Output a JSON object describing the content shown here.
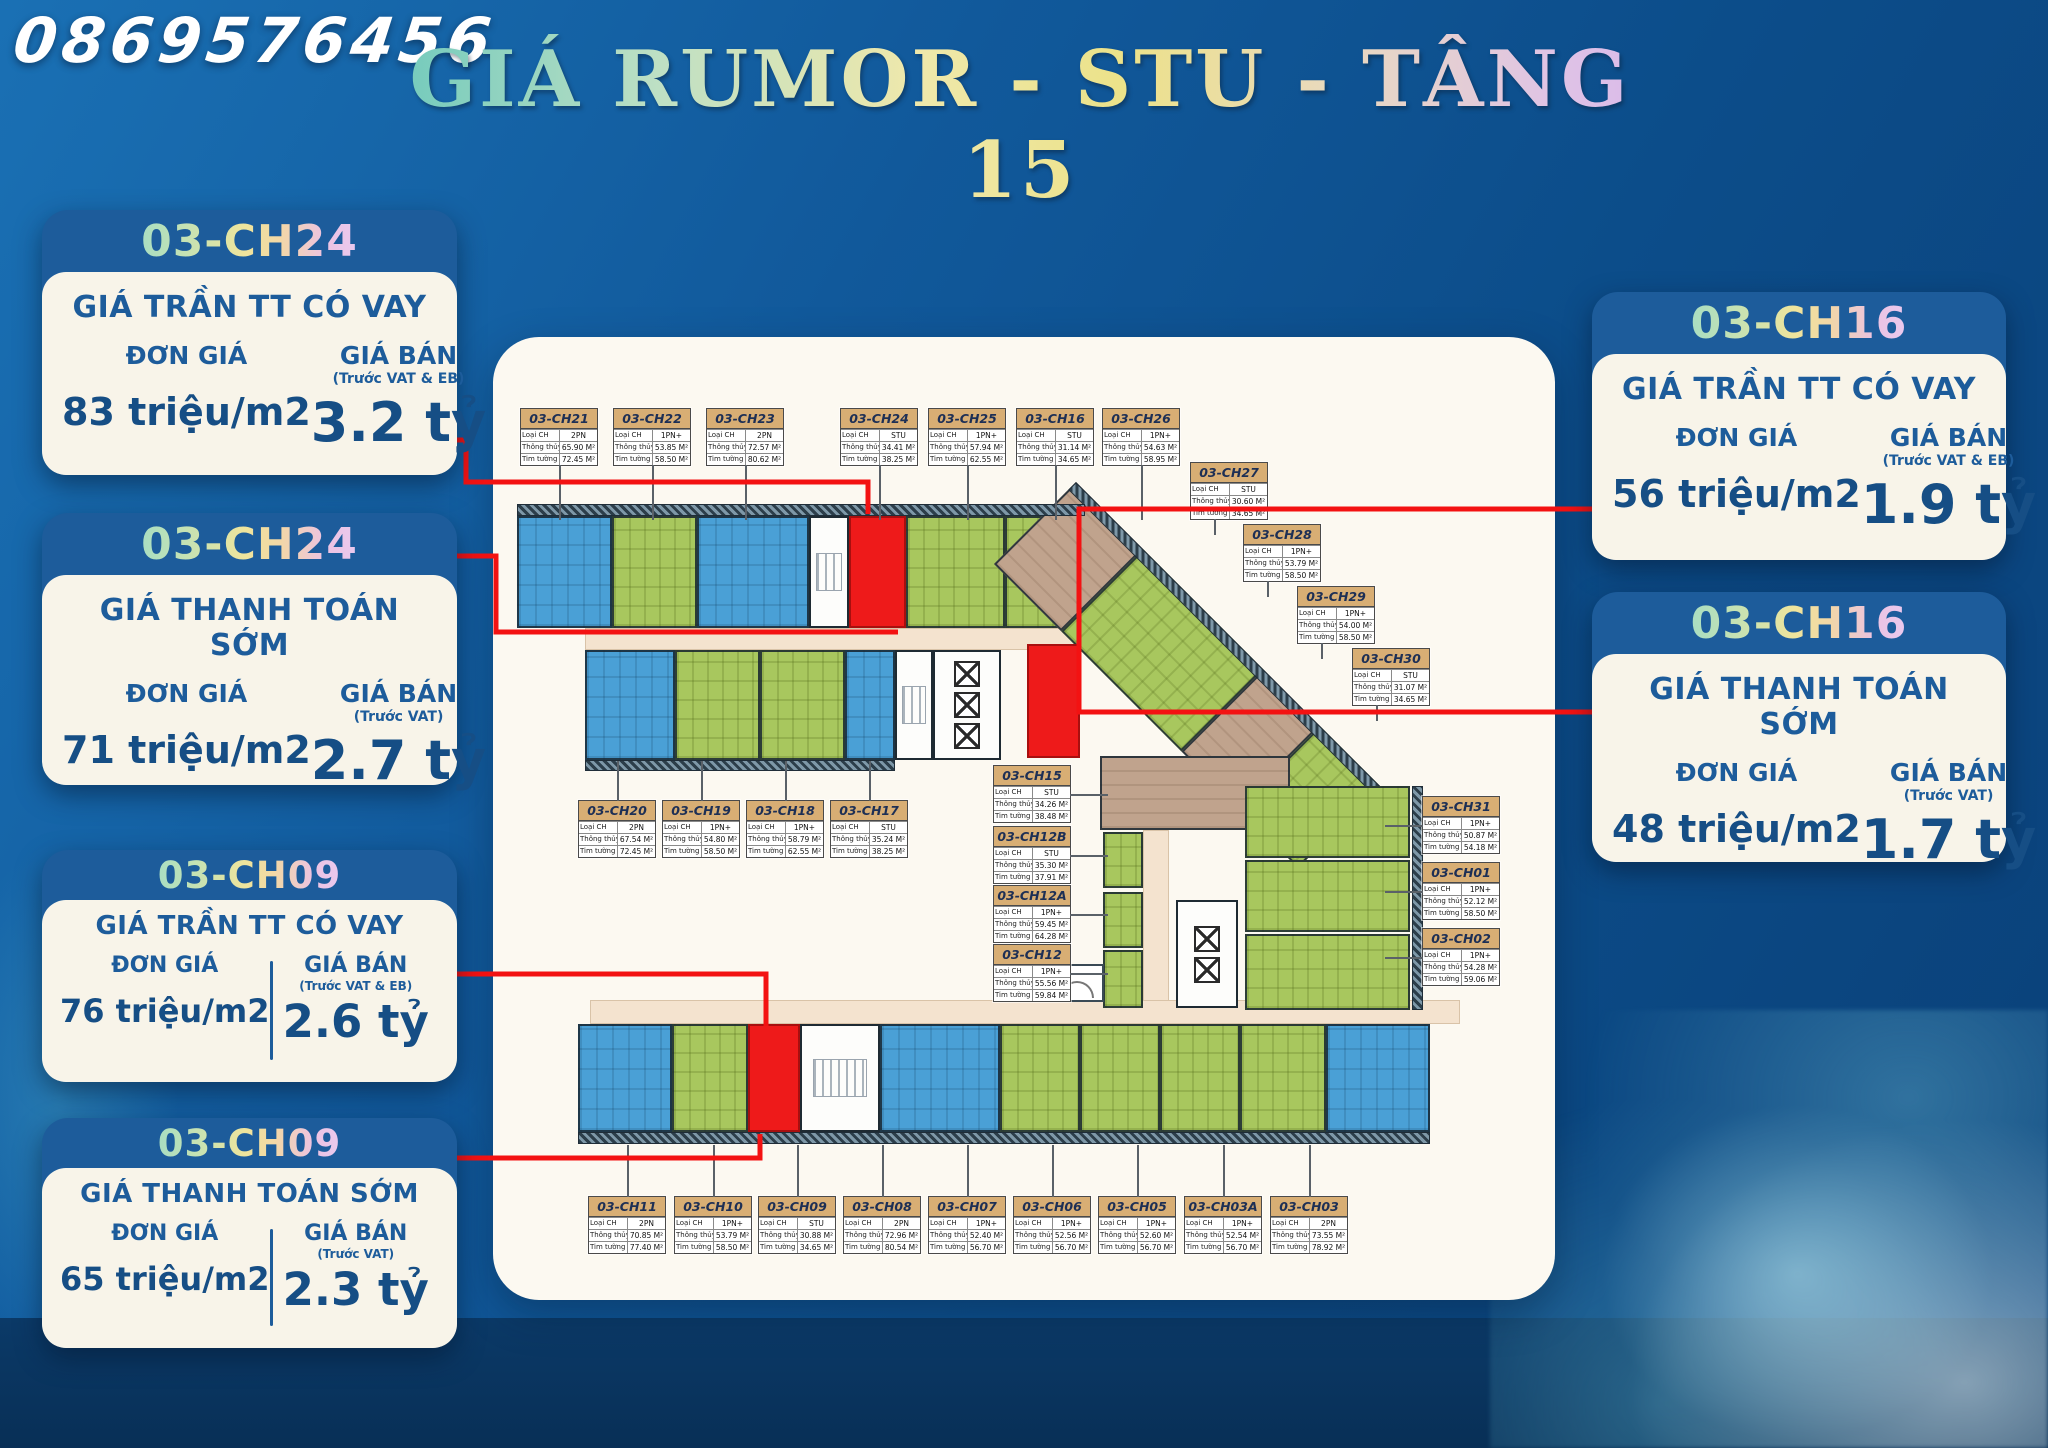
{
  "header": {
    "phone": "0869576456",
    "title": "GIÁ RUMOR - STU - TẦNG 15"
  },
  "colors": {
    "background_blue": "#0f5694",
    "bottom_band_navy": "#0b3a68",
    "card_header_blue": "#1d5c9b",
    "card_body_cream": "#f8f4e9",
    "accent_red": "#f31212",
    "highlight_unit_red": "#ee1a1a",
    "unit_blue": "#4aa0d6",
    "unit_green": "#a8c75e",
    "unit_brown": "#c0a38d",
    "corridor_beige": "#f4e3cf",
    "label_header_tan": "#d8ae74"
  },
  "cards": [
    {
      "code": "03-CH24",
      "title": "GIÁ TRẦN TT CÓ VAY",
      "don_gia_label": "ĐƠN GIÁ",
      "don_gia": "83 triệu/m2",
      "gia_ban_label": "GIÁ BÁN",
      "gia_ban_note": "(Trước VAT & EB)",
      "gia_ban": "3.2 tỷ"
    },
    {
      "code": "03-CH24",
      "title": "GIÁ THANH TOÁN SỚM",
      "don_gia_label": "ĐƠN GIÁ",
      "don_gia": "71 triệu/m2",
      "gia_ban_label": "GIÁ BÁN",
      "gia_ban_note": "(Trước VAT)",
      "gia_ban": "2.7 tỷ"
    },
    {
      "code": "03-CH09",
      "title": "GIÁ TRẦN TT CÓ VAY",
      "don_gia_label": "ĐƠN GIÁ",
      "don_gia": "76 triệu/m2",
      "gia_ban_label": "GIÁ BÁN",
      "gia_ban_note": "(Trước VAT & EB)",
      "gia_ban": "2.6 tỷ"
    },
    {
      "code": "03-CH09",
      "title": "GIÁ THANH TOÁN SỚM",
      "don_gia_label": "ĐƠN GIÁ",
      "don_gia": "65 triệu/m2",
      "gia_ban_label": "GIÁ BÁN",
      "gia_ban_note": "(Trước VAT)",
      "gia_ban": "2.3 tỷ"
    },
    {
      "code": "03-CH16",
      "title": "GIÁ TRẦN TT CÓ VAY",
      "don_gia_label": "ĐƠN GIÁ",
      "don_gia": "56 triệu/m2",
      "gia_ban_label": "GIÁ BÁN",
      "gia_ban_note": "(Trước VAT & EB)",
      "gia_ban": "1.9 tỷ"
    },
    {
      "code": "03-CH16",
      "title": "GIÁ THANH TOÁN SỚM",
      "don_gia_label": "ĐƠN GIÁ",
      "don_gia": "48 triệu/m2",
      "gia_ban_label": "GIÁ BÁN",
      "gia_ban_note": "(Trước VAT)",
      "gia_ban": "1.7 tỷ"
    }
  ],
  "plan": {
    "fields": {
      "type": "Loại CH",
      "net": "Thông thủy",
      "gross": "Tim tường"
    },
    "labels": [
      {
        "code": "03-CH21",
        "type": "2PN",
        "net": "65.90 M²",
        "gross": "72.45 M²",
        "x": 520,
        "y": 408,
        "stub": "down"
      },
      {
        "code": "03-CH22",
        "type": "1PN+",
        "net": "53.85 M²",
        "gross": "58.50 M²",
        "x": 613,
        "y": 408,
        "stub": "down"
      },
      {
        "code": "03-CH23",
        "type": "2PN",
        "net": "72.57 M²",
        "gross": "80.62 M²",
        "x": 706,
        "y": 408,
        "stub": "down"
      },
      {
        "code": "03-CH24",
        "type": "STU",
        "net": "34.41 M²",
        "gross": "38.25 M²",
        "x": 840,
        "y": 408,
        "stub": "down"
      },
      {
        "code": "03-CH25",
        "type": "1PN+",
        "net": "57.94 M²",
        "gross": "62.55 M²",
        "x": 928,
        "y": 408,
        "stub": "down"
      },
      {
        "code": "03-CH16",
        "type": "STU",
        "net": "31.14 M²",
        "gross": "34.65 M²",
        "x": 1016,
        "y": 408,
        "stub": "down"
      },
      {
        "code": "03-CH26",
        "type": "1PN+",
        "net": "54.63 M²",
        "gross": "58.95 M²",
        "x": 1102,
        "y": 408,
        "stub": "down"
      },
      {
        "code": "03-CH27",
        "type": "STU",
        "net": "30.60 M²",
        "gross": "34.65 M²",
        "x": 1190,
        "y": 462,
        "stub": "down-sm"
      },
      {
        "code": "03-CH28",
        "type": "1PN+",
        "net": "53.79 M²",
        "gross": "58.50 M²",
        "x": 1243,
        "y": 524,
        "stub": "down-sm"
      },
      {
        "code": "03-CH29",
        "type": "1PN+",
        "net": "54.00 M²",
        "gross": "58.50 M²",
        "x": 1297,
        "y": 586,
        "stub": "down-sm"
      },
      {
        "code": "03-CH30",
        "type": "STU",
        "net": "31.07 M²",
        "gross": "34.65 M²",
        "x": 1352,
        "y": 648,
        "stub": "down-sm"
      },
      {
        "code": "03-CH20",
        "type": "2PN",
        "net": "67.54 M²",
        "gross": "72.45 M²",
        "x": 578,
        "y": 800,
        "stub": "up"
      },
      {
        "code": "03-CH19",
        "type": "1PN+",
        "net": "54.80 M²",
        "gross": "58.50 M²",
        "x": 662,
        "y": 800,
        "stub": "up"
      },
      {
        "code": "03-CH18",
        "type": "1PN+",
        "net": "58.79 M²",
        "gross": "62.55 M²",
        "x": 746,
        "y": 800,
        "stub": "up"
      },
      {
        "code": "03-CH17",
        "type": "STU",
        "net": "35.24 M²",
        "gross": "38.25 M²",
        "x": 830,
        "y": 800,
        "stub": "up"
      },
      {
        "code": "03-CH15",
        "type": "STU",
        "net": "34.26 M²",
        "gross": "38.48 M²",
        "x": 993,
        "y": 765,
        "stub": "right"
      },
      {
        "code": "03-CH12B",
        "type": "STU",
        "net": "35.30 M²",
        "gross": "37.91 M²",
        "x": 993,
        "y": 826,
        "stub": "right"
      },
      {
        "code": "03-CH12A",
        "type": "1PN+",
        "net": "59.45 M²",
        "gross": "64.28 M²",
        "x": 993,
        "y": 885,
        "stub": "right"
      },
      {
        "code": "03-CH12",
        "type": "1PN+",
        "net": "55.56 M²",
        "gross": "59.84 M²",
        "x": 993,
        "y": 944,
        "stub": "right"
      },
      {
        "code": "03-CH31",
        "type": "1PN+",
        "net": "50.87 M²",
        "gross": "54.18 M²",
        "x": 1422,
        "y": 796,
        "stub": "left"
      },
      {
        "code": "03-CH01",
        "type": "1PN+",
        "net": "52.12 M²",
        "gross": "58.50 M²",
        "x": 1422,
        "y": 862,
        "stub": "left"
      },
      {
        "code": "03-CH02",
        "type": "1PN+",
        "net": "54.28 M²",
        "gross": "59.06 M²",
        "x": 1422,
        "y": 928,
        "stub": "left"
      },
      {
        "code": "03-CH11",
        "type": "2PN",
        "net": "70.85 M²",
        "gross": "77.40 M²",
        "x": 588,
        "y": 1196,
        "stub": "up-lg"
      },
      {
        "code": "03-CH10",
        "type": "1PN+",
        "net": "53.79 M²",
        "gross": "58.50 M²",
        "x": 674,
        "y": 1196,
        "stub": "up-lg"
      },
      {
        "code": "03-CH09",
        "type": "STU",
        "net": "30.88 M²",
        "gross": "34.65 M²",
        "x": 758,
        "y": 1196,
        "stub": "up-lg"
      },
      {
        "code": "03-CH08",
        "type": "2PN",
        "net": "72.96 M²",
        "gross": "80.54 M²",
        "x": 843,
        "y": 1196,
        "stub": "up-lg"
      },
      {
        "code": "03-CH07",
        "type": "1PN+",
        "net": "52.40 M²",
        "gross": "56.70 M²",
        "x": 928,
        "y": 1196,
        "stub": "up-lg"
      },
      {
        "code": "03-CH06",
        "type": "1PN+",
        "net": "52.56 M²",
        "gross": "56.70 M²",
        "x": 1013,
        "y": 1196,
        "stub": "up-lg"
      },
      {
        "code": "03-CH05",
        "type": "1PN+",
        "net": "52.60 M²",
        "gross": "56.70 M²",
        "x": 1098,
        "y": 1196,
        "stub": "up-lg"
      },
      {
        "code": "03-CH03A",
        "type": "1PN+",
        "net": "52.54 M²",
        "gross": "56.70 M²",
        "x": 1184,
        "y": 1196,
        "stub": "up-lg"
      },
      {
        "code": "03-CH03",
        "type": "2PN",
        "net": "73.55 M²",
        "gross": "78.92 M²",
        "x": 1270,
        "y": 1196,
        "stub": "up-lg"
      }
    ]
  }
}
